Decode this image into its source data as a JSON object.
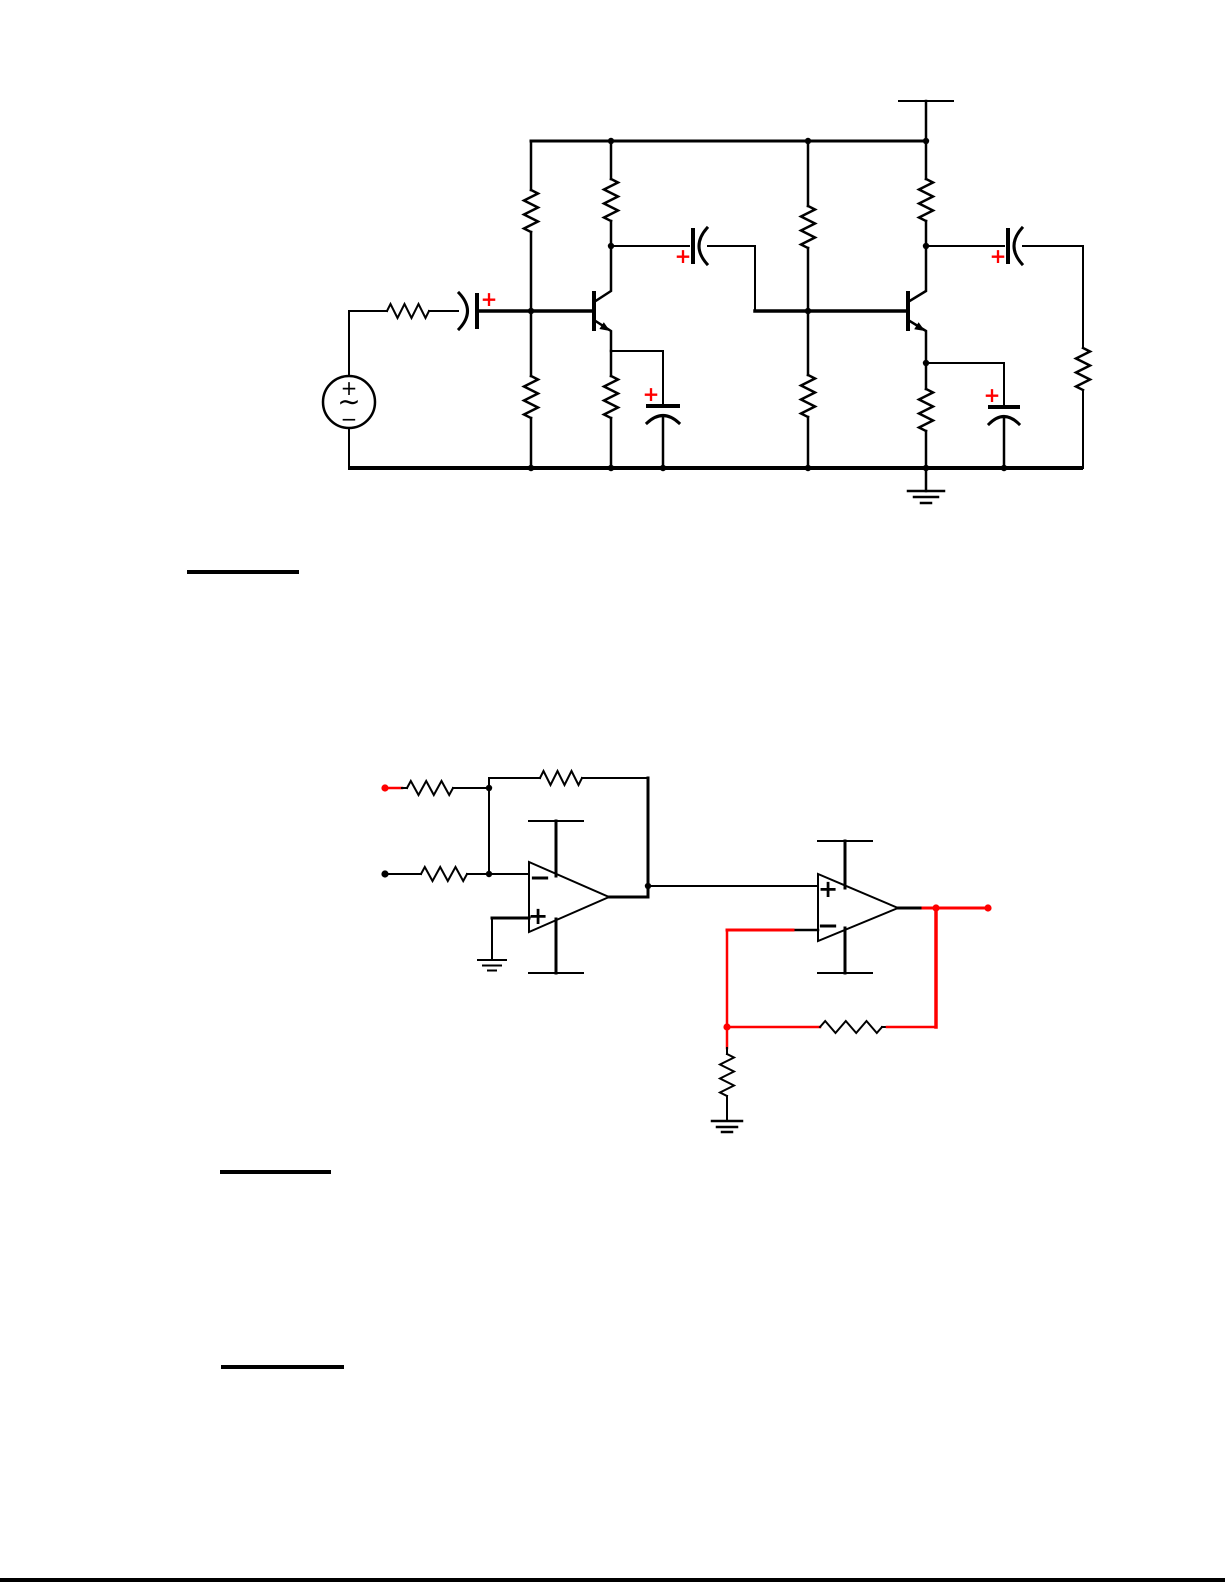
{
  "colors": {
    "background": "#ffffff",
    "ink": "#000000",
    "accent_red": "#ff0000"
  },
  "circuit1": {
    "ac_source": {
      "plus": "+",
      "sine": "∼",
      "minus": "−"
    },
    "capacitors": {
      "input": {
        "polarity": "+"
      },
      "interstage": {
        "polarity": "+"
      },
      "output": {
        "polarity": "+"
      },
      "bypass1": {
        "polarity": "+"
      },
      "bypass2": {
        "polarity": "+"
      }
    }
  },
  "circuit2": {
    "opamp1": {
      "top_input": "−",
      "bottom_input": "+"
    },
    "opamp2": {
      "top_input": "+",
      "bottom_input": "−"
    }
  }
}
